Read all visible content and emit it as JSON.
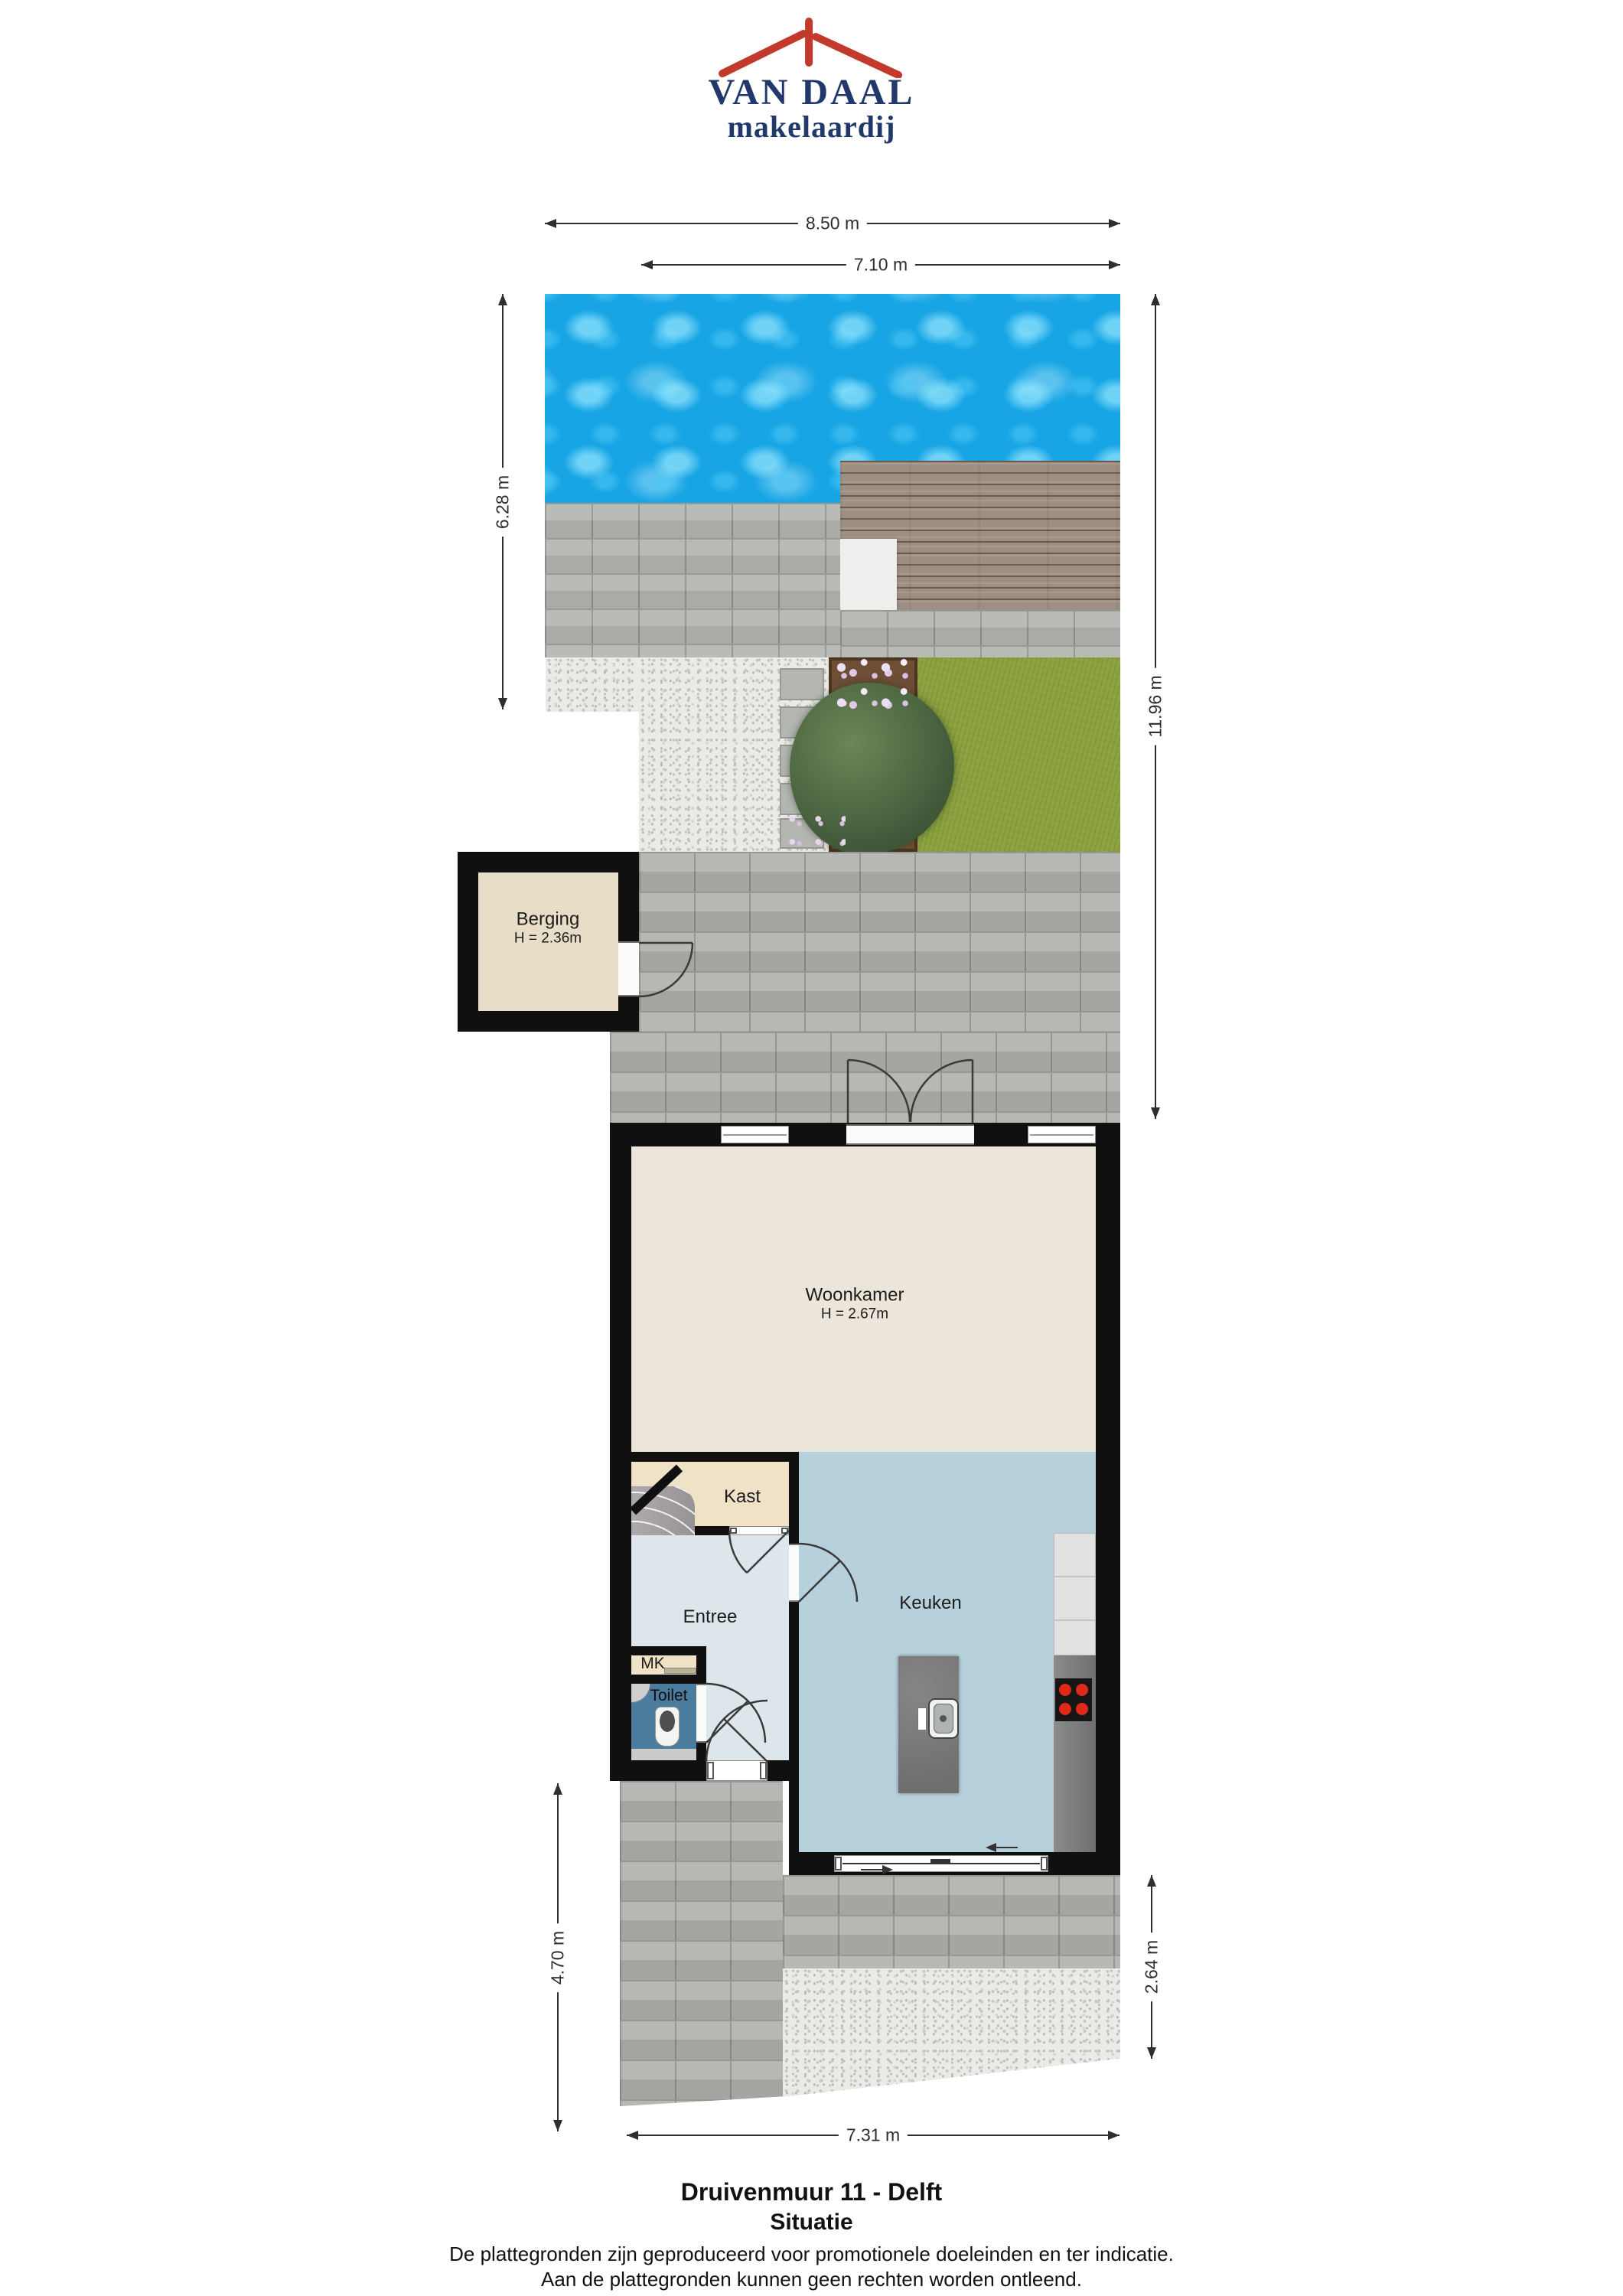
{
  "logo": {
    "company": "VAN DAAL",
    "tagline": "makelaardij"
  },
  "dimensions": {
    "top_outer": "8.50 m",
    "top_inner": "7.10 m",
    "garden_left": "6.28 m",
    "garden_right": "11.96 m",
    "front_left": "4.70 m",
    "front_right": "2.64 m",
    "bottom": "7.31 m"
  },
  "rooms": {
    "berging": {
      "label": "Berging",
      "ceiling": "H = 2.36m"
    },
    "woonkamer": {
      "label": "Woonkamer",
      "ceiling": "H = 2.67m"
    },
    "kast": {
      "label": "Kast"
    },
    "entree": {
      "label": "Entree"
    },
    "mk": {
      "label": "MK"
    },
    "toilet": {
      "label": "Toilet"
    },
    "keuken": {
      "label": "Keuken"
    }
  },
  "footer": {
    "address": "Druivenmuur 11 - Delft",
    "plan_title": "Situatie",
    "disclaimer_line1": "De plattegronden zijn geproduceerd voor promotionele doeleinden en ter indicatie.",
    "disclaimer_line2": "Aan de plattegronden kunnen geen rechten worden ontleend."
  },
  "colors": {
    "logo_navy": "#21386b",
    "logo_red": "#c23a2b",
    "wall": "#101010",
    "water": "#17a5e5",
    "deck": "#9d8f84",
    "paving": "#b3b6b0",
    "gravel": "#eceae6",
    "grass": "#8ca13f",
    "woonkamer_floor": "#ece5da",
    "kast_floor": "#efe2c6",
    "berging_floor": "#e8dec8",
    "entree_floor": "#dde6ea",
    "keuken_floor": "#b7d1dc",
    "toilet_floor": "#4b7c9e",
    "island": "#7b7b7b",
    "burner_red": "#e02819"
  }
}
